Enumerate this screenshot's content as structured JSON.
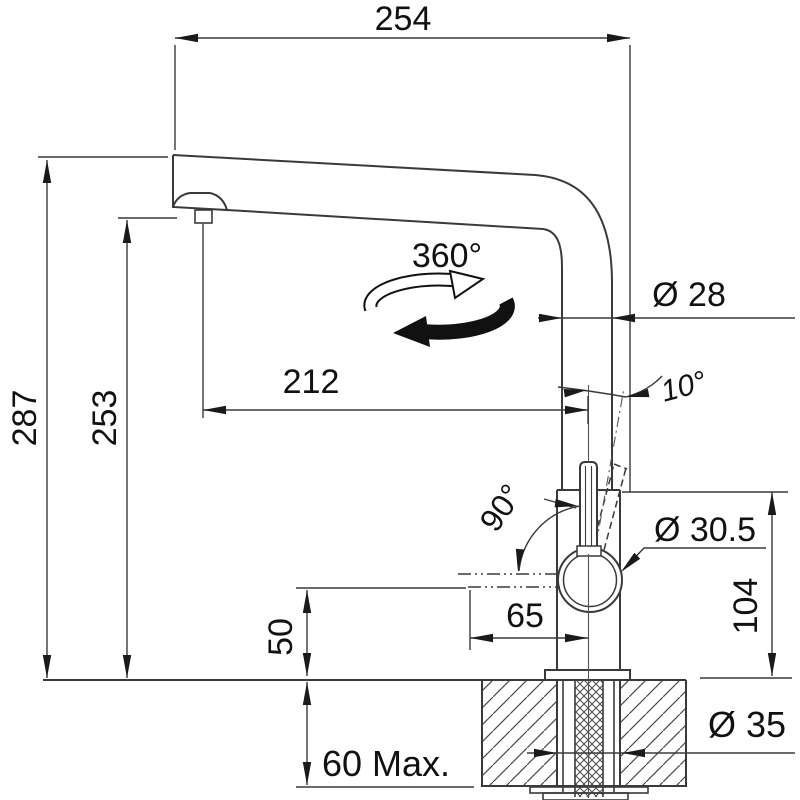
{
  "drawing": {
    "line_color": "#3a3a3a",
    "text_color": "#111111",
    "dimensions": {
      "width_total": "254",
      "height_total": "287",
      "height_spout": "253",
      "spout_reach": "212",
      "pipe_diameter": "Ø 28",
      "lever_tilt_angle": "10°",
      "swivel_angle": "360°",
      "lever_swing_angle": "90°",
      "handle_diameter": "Ø 30.5",
      "body_height": "104",
      "lever_reach": "65",
      "lever_clearance": "50",
      "deck_thickness": "60 Max.",
      "hole_diameter": "Ø 35"
    }
  }
}
